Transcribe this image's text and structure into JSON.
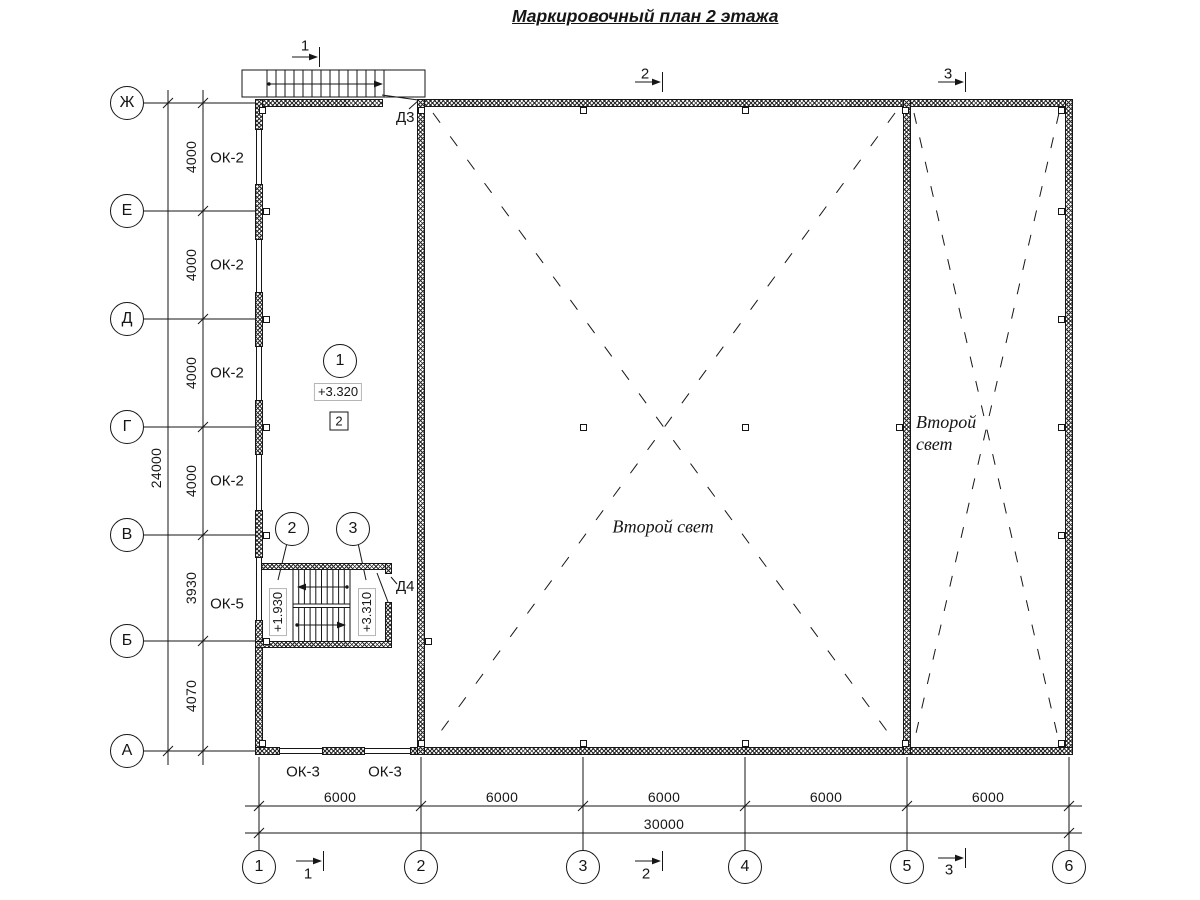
{
  "title": "Маркировочный план 2 этажа",
  "axes": {
    "rows": [
      "Ж",
      "Е",
      "Д",
      "Г",
      "В",
      "Б",
      "А"
    ],
    "cols": [
      "1",
      "2",
      "3",
      "4",
      "5",
      "6"
    ]
  },
  "dims": {
    "left": [
      "4000",
      "4000",
      "4000",
      "4000",
      "3930",
      "4070"
    ],
    "left_total": "24000",
    "bottom": [
      "6000",
      "6000",
      "6000",
      "6000",
      "6000"
    ],
    "bottom_total": "30000"
  },
  "labels": {
    "ok2": "ОК-2",
    "ok5": "ОК-5",
    "ok3": "ОК-3"
  },
  "doors": {
    "d3": "Д3",
    "d4": "Д4"
  },
  "elev": {
    "main": "+3.320",
    "low": "+1.930",
    "high": "+3.310"
  },
  "details": {
    "c1": "1",
    "c2": "2",
    "c3": "3",
    "sq": "2"
  },
  "sections": [
    "1",
    "2",
    "3"
  ],
  "svet": {
    "central": "Второй свет",
    "r1": "Второй",
    "r2": "свет"
  },
  "colors": {
    "ink": "#161616",
    "paper": "#ffffff"
  }
}
